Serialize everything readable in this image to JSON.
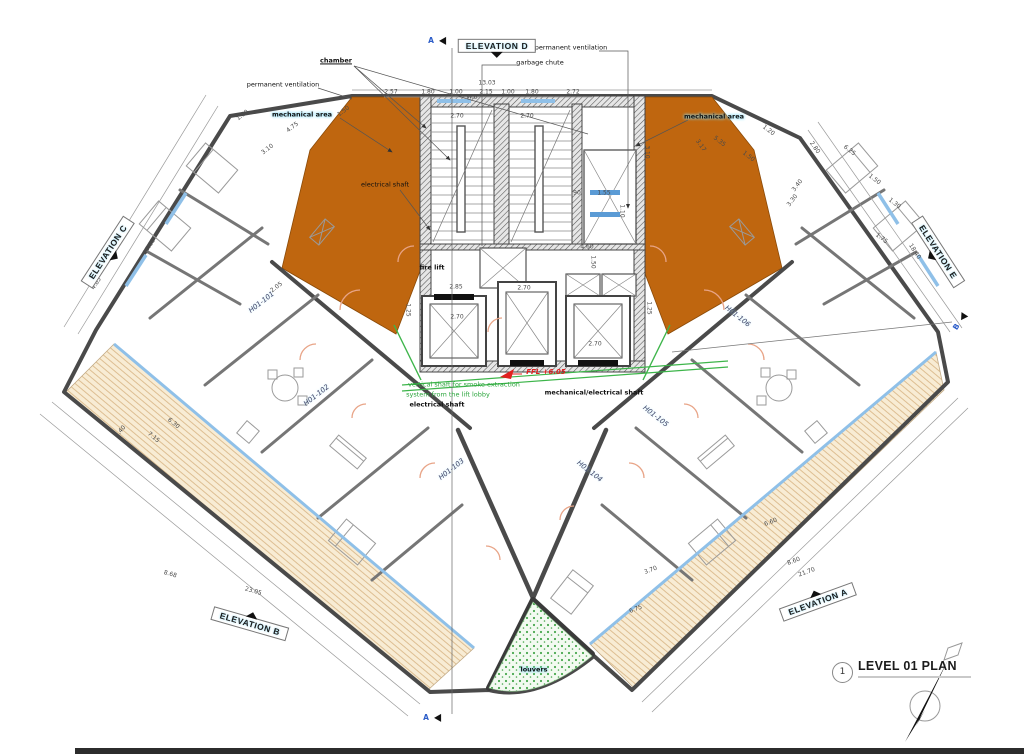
{
  "colors": {
    "mechanical_area_orange": "#bf660f",
    "deck_fill": "#f8ecd4",
    "deck_hatch": "#ddbe92",
    "glazing_blue": "#8fc0e8",
    "smoke_shaft_green": "#3db54a",
    "ffl_red": "#e02020",
    "wall_gray": "#4a4a4a"
  },
  "title_block": {
    "number": "1",
    "title": "LEVEL 01 PLAN"
  },
  "elevations": [
    {
      "label": "ELEVATION D",
      "x": 497,
      "y": 46,
      "r": 0,
      "arrow": "bottom"
    },
    {
      "label": "ELEVATION C",
      "x": 108,
      "y": 252,
      "r": -57,
      "arrow": "bottom"
    },
    {
      "label": "ELEVATION E",
      "x": 938,
      "y": 252,
      "r": 57,
      "arrow": "bottom"
    },
    {
      "label": "ELEVATION B",
      "x": 250,
      "y": 624,
      "r": 16,
      "arrow": "top"
    },
    {
      "label": "ELEVATION A",
      "x": 818,
      "y": 602,
      "r": -20,
      "arrow": "top"
    }
  ],
  "rooms": [
    {
      "id": "H01-101",
      "x": 262,
      "y": 303,
      "r": -38
    },
    {
      "id": "H01-102",
      "x": 317,
      "y": 396,
      "r": -38
    },
    {
      "id": "H01-103",
      "x": 452,
      "y": 470,
      "r": -38
    },
    {
      "id": "H01-104",
      "x": 589,
      "y": 472,
      "r": 38
    },
    {
      "id": "H01-105",
      "x": 655,
      "y": 417,
      "r": 38
    },
    {
      "id": "H01-106",
      "x": 737,
      "y": 317,
      "r": 38
    }
  ],
  "annotations": [
    {
      "t": "chamber",
      "x": 336,
      "y": 61,
      "cls": "bold-ul"
    },
    {
      "t": "permanent ventilation",
      "x": 283,
      "y": 85
    },
    {
      "t": "permanent ventilation",
      "x": 571,
      "y": 48
    },
    {
      "t": "garbage chute",
      "x": 540,
      "y": 63
    },
    {
      "t": "mechanical area",
      "x": 302,
      "y": 115,
      "cls": "hl"
    },
    {
      "t": "mechanical area",
      "x": 714,
      "y": 117,
      "cls": "hl"
    },
    {
      "t": "electrical shaft",
      "x": 385,
      "y": 185
    },
    {
      "t": "fire lift",
      "x": 432,
      "y": 268,
      "cls": "bold"
    },
    {
      "t": "FFL +6.05",
      "x": 546,
      "y": 373,
      "cls": "red"
    },
    {
      "t": "vertical shaft for smoke extraction",
      "x": 464,
      "y": 385,
      "cls": "green"
    },
    {
      "t": "system from the lift lobby",
      "x": 448,
      "y": 395,
      "cls": "green"
    },
    {
      "t": "mechanical/electrical shaft",
      "x": 594,
      "y": 393,
      "cls": "bold"
    },
    {
      "t": "electrical shaft",
      "x": 437,
      "y": 405,
      "cls": "bold"
    },
    {
      "t": "louvers",
      "x": 534,
      "y": 670,
      "cls": "hl"
    }
  ],
  "section_markers": [
    {
      "t": "A",
      "x": 437,
      "y": 41,
      "r": 0
    },
    {
      "t": "A",
      "x": 432,
      "y": 718,
      "r": 0
    },
    {
      "t": "B",
      "x": 960,
      "y": 322,
      "r": -57
    }
  ],
  "dimensions": [
    {
      "t": "13.03",
      "x": 487,
      "y": 84,
      "r": 0
    },
    {
      "t": "2.57",
      "x": 391,
      "y": 93,
      "r": 0
    },
    {
      "t": "1.80",
      "x": 428,
      "y": 93,
      "r": 0
    },
    {
      "t": "1.00",
      "x": 456,
      "y": 93,
      "r": 0
    },
    {
      "t": "W.B",
      "x": 472,
      "y": 98,
      "r": 0
    },
    {
      "t": "2.15",
      "x": 486,
      "y": 93,
      "r": 0
    },
    {
      "t": "1.00",
      "x": 508,
      "y": 93,
      "r": 0
    },
    {
      "t": "1.80",
      "x": 532,
      "y": 93,
      "r": 0
    },
    {
      "t": "2.72",
      "x": 573,
      "y": 93,
      "r": 0
    },
    {
      "t": "2.70",
      "x": 457,
      "y": 117,
      "r": 0
    },
    {
      "t": "2.70",
      "x": 527,
      "y": 117,
      "r": 0
    },
    {
      "t": "3.10",
      "x": 646,
      "y": 152,
      "r": 90
    },
    {
      "t": "3.17",
      "x": 700,
      "y": 146,
      "r": 55
    },
    {
      "t": ".90",
      "x": 576,
      "y": 194,
      "r": 0
    },
    {
      "t": "1.55",
      "x": 604,
      "y": 194,
      "r": 0
    },
    {
      "t": "1.10",
      "x": 621,
      "y": 211,
      "r": 90
    },
    {
      "t": "2.85",
      "x": 456,
      "y": 288,
      "r": 0
    },
    {
      "t": "2.70",
      "x": 524,
      "y": 289,
      "r": 0
    },
    {
      "t": "1.25",
      "x": 407,
      "y": 310,
      "r": 90
    },
    {
      "t": "2.70",
      "x": 457,
      "y": 318,
      "r": 0
    },
    {
      "t": "4.60",
      "x": 587,
      "y": 248,
      "r": 0
    },
    {
      "t": "1.50",
      "x": 592,
      "y": 262,
      "r": 90
    },
    {
      "t": "2.70",
      "x": 595,
      "y": 345,
      "r": 0
    },
    {
      "t": "1.25",
      "x": 648,
      "y": 308,
      "r": 90
    },
    {
      "t": "17.68",
      "x": 150,
      "y": 247,
      "r": -57
    },
    {
      "t": "4.85",
      "x": 97,
      "y": 284,
      "r": -57
    },
    {
      "t": "18.40",
      "x": 914,
      "y": 252,
      "r": 57
    },
    {
      "t": "23.05",
      "x": 253,
      "y": 592,
      "r": 16
    },
    {
      "t": "8.68",
      "x": 170,
      "y": 575,
      "r": 16
    },
    {
      "t": "21.70",
      "x": 807,
      "y": 573,
      "r": -20
    },
    {
      "t": "8.60",
      "x": 794,
      "y": 562,
      "r": -20
    },
    {
      "t": "6.60",
      "x": 771,
      "y": 523,
      "r": -20
    },
    {
      "t": "6.75",
      "x": 636,
      "y": 610,
      "r": -20
    },
    {
      "t": "3.70",
      "x": 651,
      "y": 571,
      "r": -20
    },
    {
      "t": "7.15",
      "x": 153,
      "y": 438,
      "r": 40
    },
    {
      "t": "6.30",
      "x": 173,
      "y": 424,
      "r": 40
    },
    {
      "t": "2.40",
      "x": 121,
      "y": 432,
      "r": -50
    },
    {
      "t": "2.05",
      "x": 277,
      "y": 288,
      "r": -38
    },
    {
      "t": "4.75",
      "x": 293,
      "y": 128,
      "r": -38
    },
    {
      "t": "1.50",
      "x": 344,
      "y": 112,
      "r": -38
    },
    {
      "t": "3.10",
      "x": 268,
      "y": 150,
      "r": -38
    },
    {
      "t": "1.60",
      "x": 243,
      "y": 116,
      "r": -38
    },
    {
      "t": "5.35",
      "x": 719,
      "y": 142,
      "r": 38
    },
    {
      "t": "1.50",
      "x": 748,
      "y": 157,
      "r": 38
    },
    {
      "t": "1.20",
      "x": 768,
      "y": 131,
      "r": 38
    },
    {
      "t": "2.80",
      "x": 814,
      "y": 148,
      "r": 55
    },
    {
      "t": "3.40",
      "x": 798,
      "y": 186,
      "r": -52
    },
    {
      "t": "3.30",
      "x": 793,
      "y": 201,
      "r": -52
    },
    {
      "t": "1.75",
      "x": 881,
      "y": 239,
      "r": 38
    },
    {
      "t": "6.25",
      "x": 849,
      "y": 151,
      "r": 38
    },
    {
      "t": "1.50",
      "x": 874,
      "y": 180,
      "r": 38
    },
    {
      "t": "1.30",
      "x": 894,
      "y": 204,
      "r": 38
    }
  ]
}
